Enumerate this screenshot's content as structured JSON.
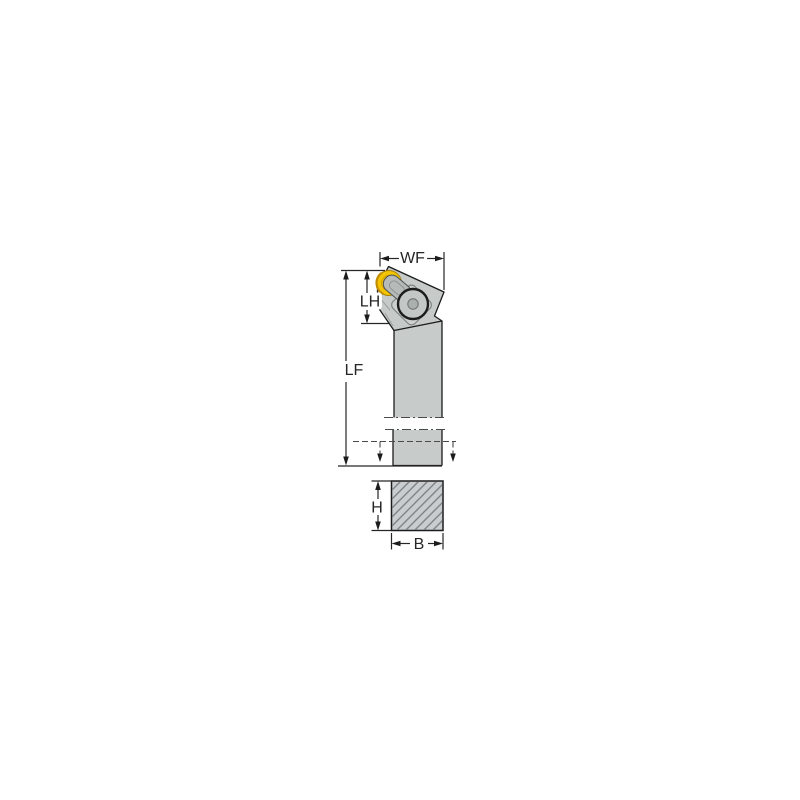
{
  "page": {
    "background": "#ffffff"
  },
  "diagram": {
    "type": "technical-dimension-drawing",
    "subject": "turning tool holder with round yellow insert, side view and shank cross-section",
    "labels": {
      "wf": "WF",
      "lh": "LH",
      "lf": "LF",
      "h": "H",
      "b": "B"
    },
    "colors": {
      "body_gray": "#c7cbca",
      "inner_plate_gray": "#ccd0cf",
      "insert_yellow": "#f3c400",
      "insert_shadow_yellow": "#c28c00",
      "outline": "#1c1c1c",
      "dimension_line": "#262626",
      "dash_gray": "#4a4a4a",
      "hatch_gray": "#7e8486",
      "background": "#ffffff"
    }
  }
}
